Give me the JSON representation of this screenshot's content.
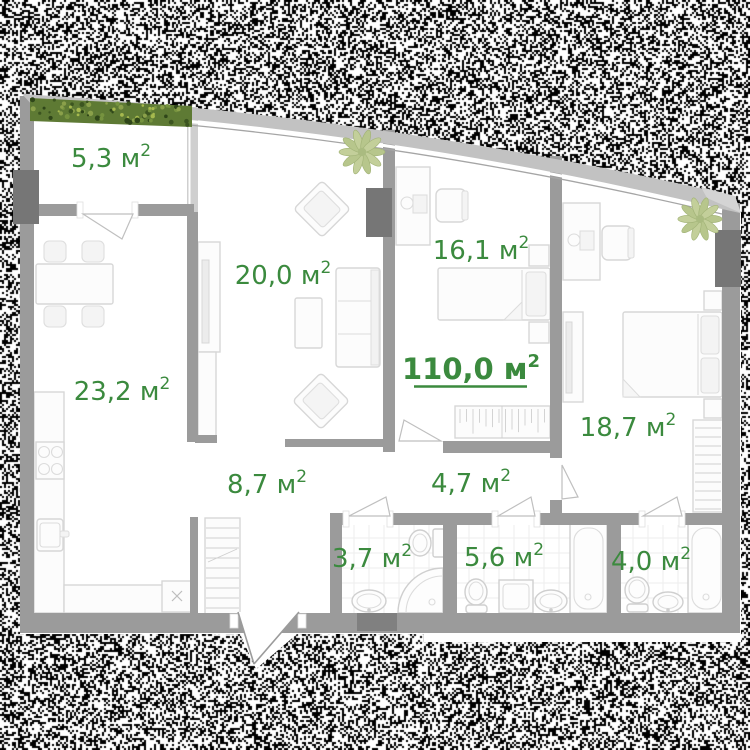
{
  "plan": {
    "accent_color": "#3b8a3e",
    "wall_color": "#9b9b9b",
    "labels": {
      "balcony": {
        "text": "5,3 м²",
        "value": "5,3 м",
        "sup": "2"
      },
      "living": {
        "text": "20,0 м²",
        "value": "20,0 м",
        "sup": "2"
      },
      "bedroom1": {
        "text": "16,1 м²",
        "value": "16,1 м",
        "sup": "2"
      },
      "total": {
        "text": "110,0 м²",
        "value": "110,0 м",
        "sup": "2"
      },
      "kitchen_living": {
        "text": "23,2 м²",
        "value": "23,2 м",
        "sup": "2"
      },
      "bedroom2": {
        "text": "18,7 м²",
        "value": "18,7 м",
        "sup": "2"
      },
      "hallway": {
        "text": "8,7 м²",
        "value": "8,7 м",
        "sup": "2"
      },
      "corridor": {
        "text": "4,7 м²",
        "value": "4,7 м",
        "sup": "2"
      },
      "bathroom1": {
        "text": "3,7 м²",
        "value": "3,7 м",
        "sup": "2"
      },
      "bathroom2": {
        "text": "5,6 м²",
        "value": "5,6 м",
        "sup": "2"
      },
      "bathroom3": {
        "text": "4,0 м²",
        "value": "4,0 м",
        "sup": "2"
      }
    }
  }
}
